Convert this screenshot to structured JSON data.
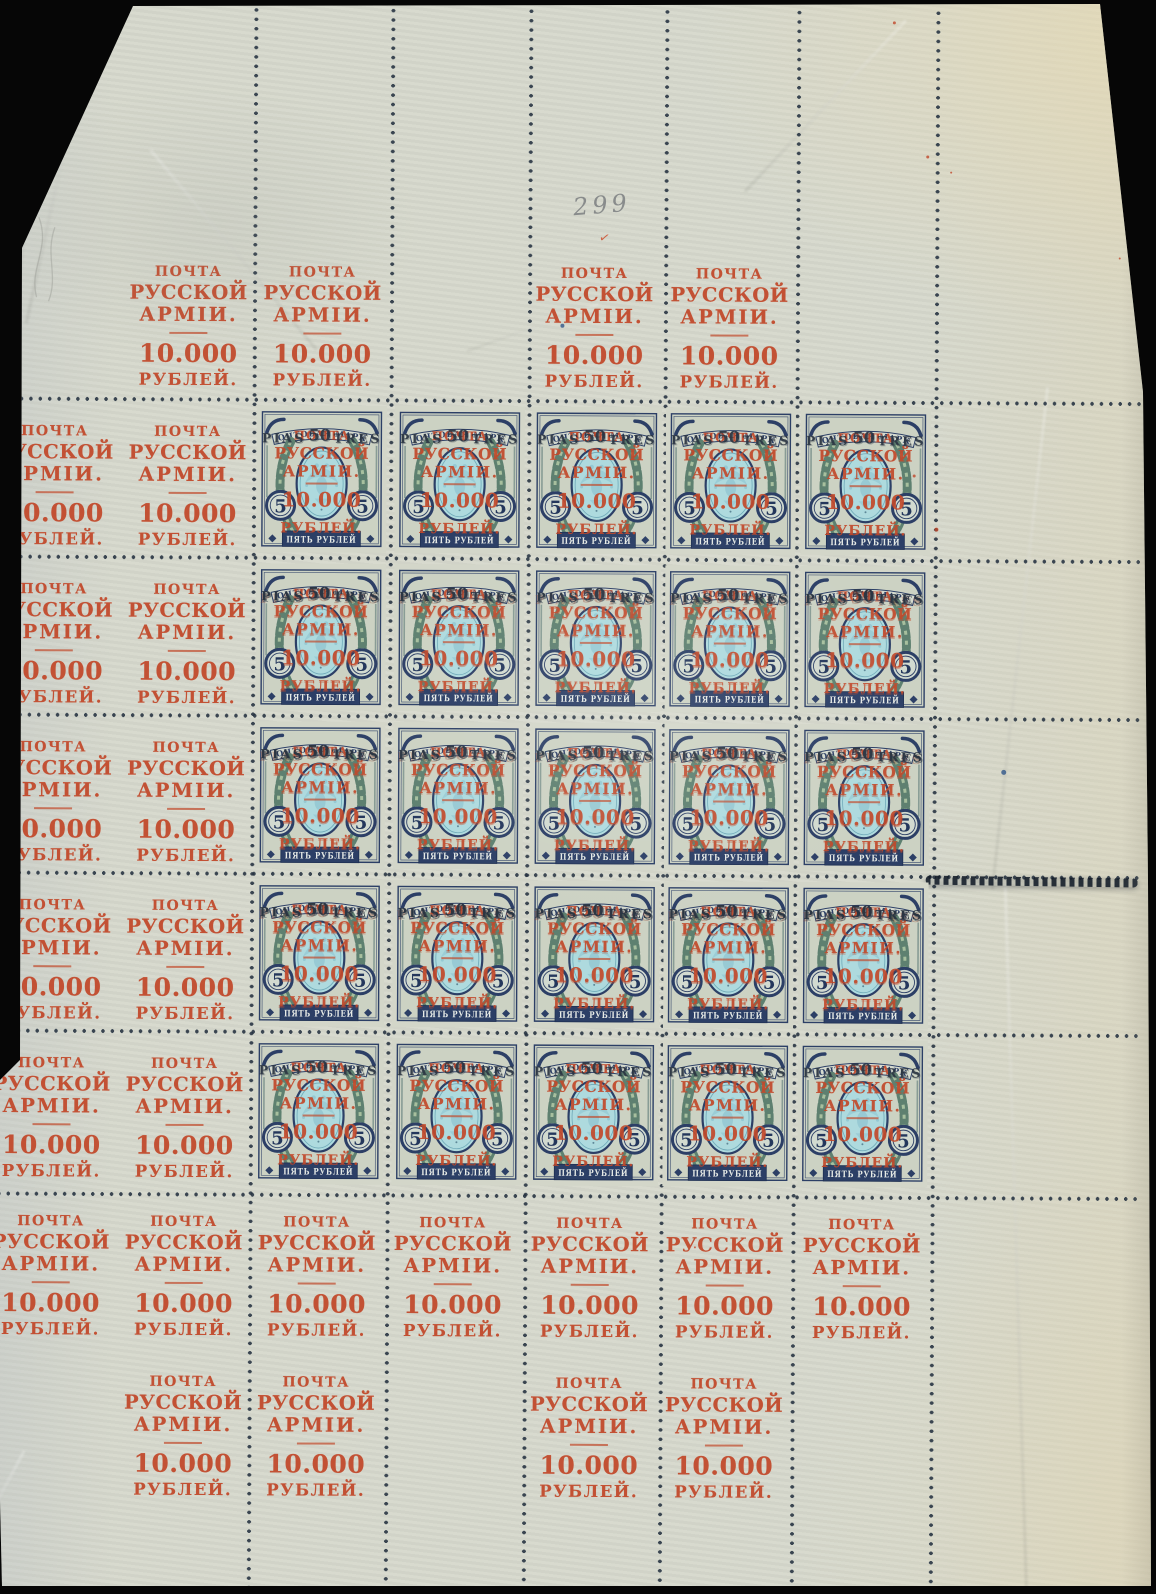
{
  "sheet": {
    "pencil_number": "299",
    "margin_overprint": {
      "line1": "ПОЧТА",
      "line2": "РУССКОЙ",
      "line3": "АРМІИ.",
      "amount": "10.000",
      "currency": "РУБЛЕЙ."
    },
    "stamp": {
      "top_banner": "ПОЧТОВАЯ МАРКА",
      "denomination_numeral": "5",
      "denomination_tablet": "ПЯТЬ РУБЛЕЙ",
      "surcharge_black": {
        "left": "PIAS",
        "value": "50",
        "right": "TRES"
      },
      "overprint_red": {
        "line1": "ПОЧТА",
        "line2": "РУССКОЙ",
        "line3": "АРМІИ.",
        "amount": "10.000",
        "currency": "РУБЛЕЙ."
      }
    },
    "grid": {
      "stamp_rows": 5,
      "stamp_columns": 5
    },
    "colors": {
      "paper": "#d6d8cc",
      "overprint_red": "#c2492b",
      "surcharge_black": "#2b3542",
      "perforation_dot": "#243140",
      "stamp_frame_blue": "#2c3f66",
      "stamp_center_turquoise": "#aedade",
      "wreath_green": "#5e8070",
      "pencil_gray": "#7c7f81"
    }
  }
}
